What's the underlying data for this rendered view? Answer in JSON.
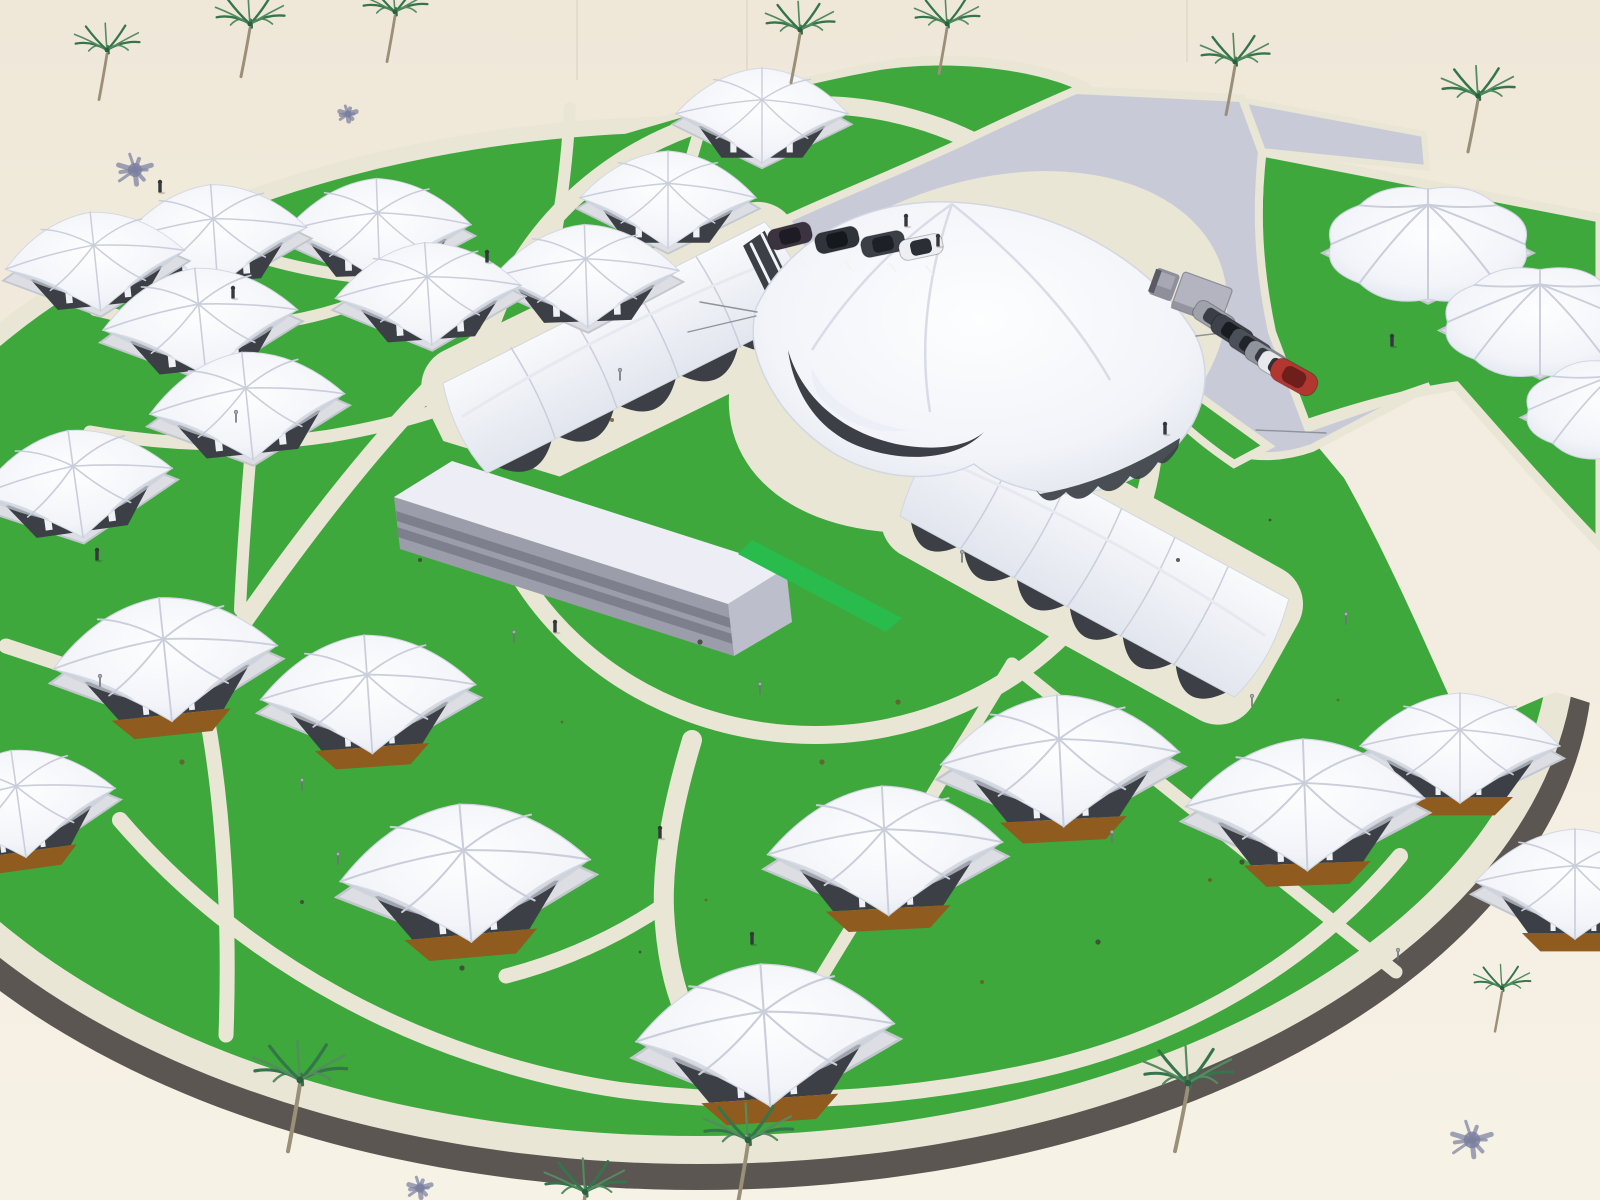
{
  "meta": {
    "scene": "aerial-3d-render-circular-desert-eco-resort-masterplan",
    "counts": {
      "square_canopy_tents": 20,
      "dome_umbrella_tents": 3,
      "long_tent_halls": 2,
      "main_pavilion": 1,
      "flat_service_building": 1,
      "palm_trees": 12,
      "palm_shadows_on_sand": 4,
      "cars_small_lot": 4,
      "vehicles_entry_lot": 7,
      "people": 11,
      "path_lamps": 12
    }
  },
  "colors": {
    "sandTop": "#EFE8D9",
    "sandBottom": "#F7F2E6",
    "sand2": "#F2EDE0",
    "seam": "#E3DCCA",
    "kerb": "#5B5651",
    "cream": "#EAE6D6",
    "grass": "#3EA83D",
    "grassBright": "#2ABB4D",
    "road": "#C9CAD8",
    "tentWhite": "#FAFBFD",
    "tentEdge": "#DDE1EB",
    "tentRib": "#C9CEDA",
    "tentDark": "#3C4046",
    "tentDeck": "#DCDEE4",
    "deckEdge": "#C2C6CD",
    "floor": "#8F5B1E",
    "mullion": "#EFF1F5",
    "slabTop": "#EDEDF5",
    "slabFront": "#9C9DAA",
    "slabStripe": "#7E7F8C",
    "slabSide": "#BDBECB",
    "palmTrunk": "#9A9078",
    "frond1": "#35754B",
    "frond2": "#558B60",
    "frondCore": "#2C5F3F",
    "shadowBlue": "#7B7FA0",
    "person": "#34373C",
    "lamp": "#6E7178",
    "lampHead": "#A7ABB2",
    "truckBox": "#B4B4C1",
    "truckBoxEdge": "#8D8D99",
    "truckCab": "#8F8F9B",
    "truckCabTop": "#A8A8B5",
    "truckGlass": "#5A5A66",
    "wire": "#8F939B",
    "stall": "#F2F2EE",
    "speckDark": "#3E4436",
    "speckBrown": "#6B5B2E"
  },
  "tents": [
    {
      "x": 95,
      "y": 258,
      "s": 0.92,
      "r": -6,
      "v": "w"
    },
    {
      "x": 214,
      "y": 232,
      "s": 0.95,
      "r": -4,
      "v": "w"
    },
    {
      "x": 378,
      "y": 226,
      "s": 0.95,
      "r": -2,
      "v": "w"
    },
    {
      "x": 200,
      "y": 318,
      "s": 1.0,
      "r": -6,
      "v": "w"
    },
    {
      "x": 428,
      "y": 290,
      "s": 0.95,
      "r": -4,
      "v": "w"
    },
    {
      "x": 586,
      "y": 272,
      "s": 0.95,
      "r": -2,
      "v": "w"
    },
    {
      "x": 668,
      "y": 196,
      "s": 0.9,
      "r": 0,
      "v": "w"
    },
    {
      "x": 762,
      "y": 112,
      "s": 0.88,
      "r": 0,
      "v": "w"
    },
    {
      "x": 247,
      "y": 402,
      "s": 1.0,
      "r": -6,
      "v": "w"
    },
    {
      "x": 75,
      "y": 480,
      "s": 1.0,
      "r": -8,
      "v": "w"
    },
    {
      "x": 165,
      "y": 655,
      "s": 1.15,
      "r": -6,
      "v": "b"
    },
    {
      "x": 368,
      "y": 690,
      "s": 1.1,
      "r": -4,
      "v": "b"
    },
    {
      "x": 18,
      "y": 800,
      "s": 1.0,
      "r": -8,
      "v": "b"
    },
    {
      "x": 465,
      "y": 868,
      "s": 1.28,
      "r": -5,
      "v": "b"
    },
    {
      "x": 885,
      "y": 846,
      "s": 1.2,
      "r": -3,
      "v": "b"
    },
    {
      "x": 765,
      "y": 1030,
      "s": 1.32,
      "r": -4,
      "v": "b"
    },
    {
      "x": 1060,
      "y": 756,
      "s": 1.22,
      "r": -3,
      "v": "b"
    },
    {
      "x": 1305,
      "y": 800,
      "s": 1.22,
      "r": -2,
      "v": "b"
    },
    {
      "x": 1460,
      "y": 744,
      "s": 1.02,
      "r": 0,
      "v": "b"
    },
    {
      "x": 1575,
      "y": 880,
      "s": 1.02,
      "r": 0,
      "v": "b"
    }
  ],
  "domes": [
    {
      "x": 1428,
      "y": 242,
      "s": 1.1
    },
    {
      "x": 1540,
      "y": 320,
      "s": 1.05
    },
    {
      "x": 1612,
      "y": 408,
      "s": 0.95
    }
  ],
  "halls": [
    {
      "x": 628,
      "y": 352,
      "len": 360,
      "wid": 118,
      "rot": -26,
      "scallops": 5,
      "cap": true
    },
    {
      "x": 1092,
      "y": 562,
      "len": 380,
      "wid": 130,
      "rot": 29,
      "scallops": 6,
      "cap": false
    }
  ],
  "palms": [
    [
      107,
      50,
      0.8,
      8
    ],
    [
      250,
      24,
      0.85,
      9
    ],
    [
      395,
      12,
      0.8,
      8
    ],
    [
      800,
      30,
      0.85,
      9
    ],
    [
      947,
      24,
      0.8,
      8
    ],
    [
      1235,
      62,
      0.85,
      9
    ],
    [
      1478,
      96,
      0.9,
      10
    ],
    [
      300,
      1080,
      1.15,
      12
    ],
    [
      585,
      1192,
      1.0,
      10
    ],
    [
      748,
      1140,
      1.1,
      11
    ],
    [
      1188,
      1083,
      1.1,
      13
    ],
    [
      1502,
      988,
      0.7,
      7
    ]
  ],
  "shadows": [
    [
      135,
      170,
      22
    ],
    [
      348,
      114,
      11
    ],
    [
      420,
      1188,
      15
    ],
    [
      1472,
      1140,
      26
    ]
  ],
  "people": [
    [
      160,
      192
    ],
    [
      233,
      298
    ],
    [
      487,
      262
    ],
    [
      97,
      560
    ],
    [
      555,
      632
    ],
    [
      660,
      838
    ],
    [
      752,
      944
    ],
    [
      1392,
      346
    ],
    [
      1165,
      434
    ],
    [
      906,
      226
    ],
    [
      938,
      246
    ]
  ],
  "lamps": [
    [
      302,
      790
    ],
    [
      338,
      864
    ],
    [
      1252,
      706
    ],
    [
      1112,
      842
    ],
    [
      1398,
      960
    ],
    [
      236,
      422
    ],
    [
      514,
      642
    ],
    [
      100,
      686
    ],
    [
      1346,
      624
    ],
    [
      760,
      694
    ],
    [
      620,
      380
    ],
    [
      962,
      562
    ]
  ],
  "specks": [
    [
      530,
      305
    ],
    [
      612,
      420
    ],
    [
      700,
      642
    ],
    [
      562,
      722
    ],
    [
      420,
      560
    ],
    [
      822,
      762
    ],
    [
      958,
      832
    ],
    [
      1122,
      762
    ],
    [
      1242,
      862
    ],
    [
      1338,
      700
    ],
    [
      1178,
      560
    ],
    [
      898,
      702
    ],
    [
      640,
      952
    ],
    [
      982,
      982
    ],
    [
      1098,
      942
    ],
    [
      818,
      1092
    ],
    [
      302,
      902
    ],
    [
      182,
      762
    ],
    [
      1270,
      520
    ],
    [
      1210,
      880
    ],
    [
      462,
      968
    ],
    [
      706,
      900
    ]
  ],
  "wires": [
    [
      700,
      302,
      757,
      312
    ],
    [
      688,
      332,
      756,
      316
    ],
    [
      1256,
      430,
      1326,
      433
    ],
    [
      1196,
      336,
      1246,
      330
    ]
  ],
  "stalls": [
    [
      800,
      258,
      806,
      266
    ],
    [
      845,
      261,
      851,
      269
    ],
    [
      890,
      264,
      896,
      272
    ],
    [
      926,
      266,
      932,
      274
    ]
  ],
  "lotA": [
    {
      "x": 790,
      "y": 236,
      "r": -14,
      "b": "#3B3440",
      "g": "#1F1B24"
    },
    {
      "x": 837,
      "y": 240,
      "r": -13,
      "b": "#2F343B",
      "g": "#15181D"
    },
    {
      "x": 883,
      "y": 244,
      "r": -12,
      "b": "#3A3F48",
      "g": "#1D2127"
    },
    {
      "x": 921,
      "y": 247,
      "r": -12,
      "b": "#EEEFF3",
      "g": "#2A2E35"
    }
  ],
  "lotB": {
    "truck": {
      "x": 1185,
      "y": 292,
      "r": 20
    },
    "cars": [
      {
        "x": 1214,
        "y": 318,
        "r": 32,
        "b": "#9FA2AB",
        "g": "#3A3E45"
      },
      {
        "x": 1232,
        "y": 332,
        "r": 32,
        "b": "#3E434B",
        "g": "#181C21"
      },
      {
        "x": 1250,
        "y": 346,
        "r": 32,
        "b": "#4A4F58",
        "g": "#20242B"
      },
      {
        "x": 1266,
        "y": 358,
        "r": 31,
        "b": "#8F939C",
        "g": "#33373E"
      },
      {
        "x": 1279,
        "y": 368,
        "r": 31,
        "b": "#E8E9ED",
        "g": "#2F333A"
      }
    ],
    "redCar": {
      "x": 1294,
      "y": 377,
      "r": 29,
      "b": "#B23730",
      "g": "#6E1F1B"
    }
  }
}
